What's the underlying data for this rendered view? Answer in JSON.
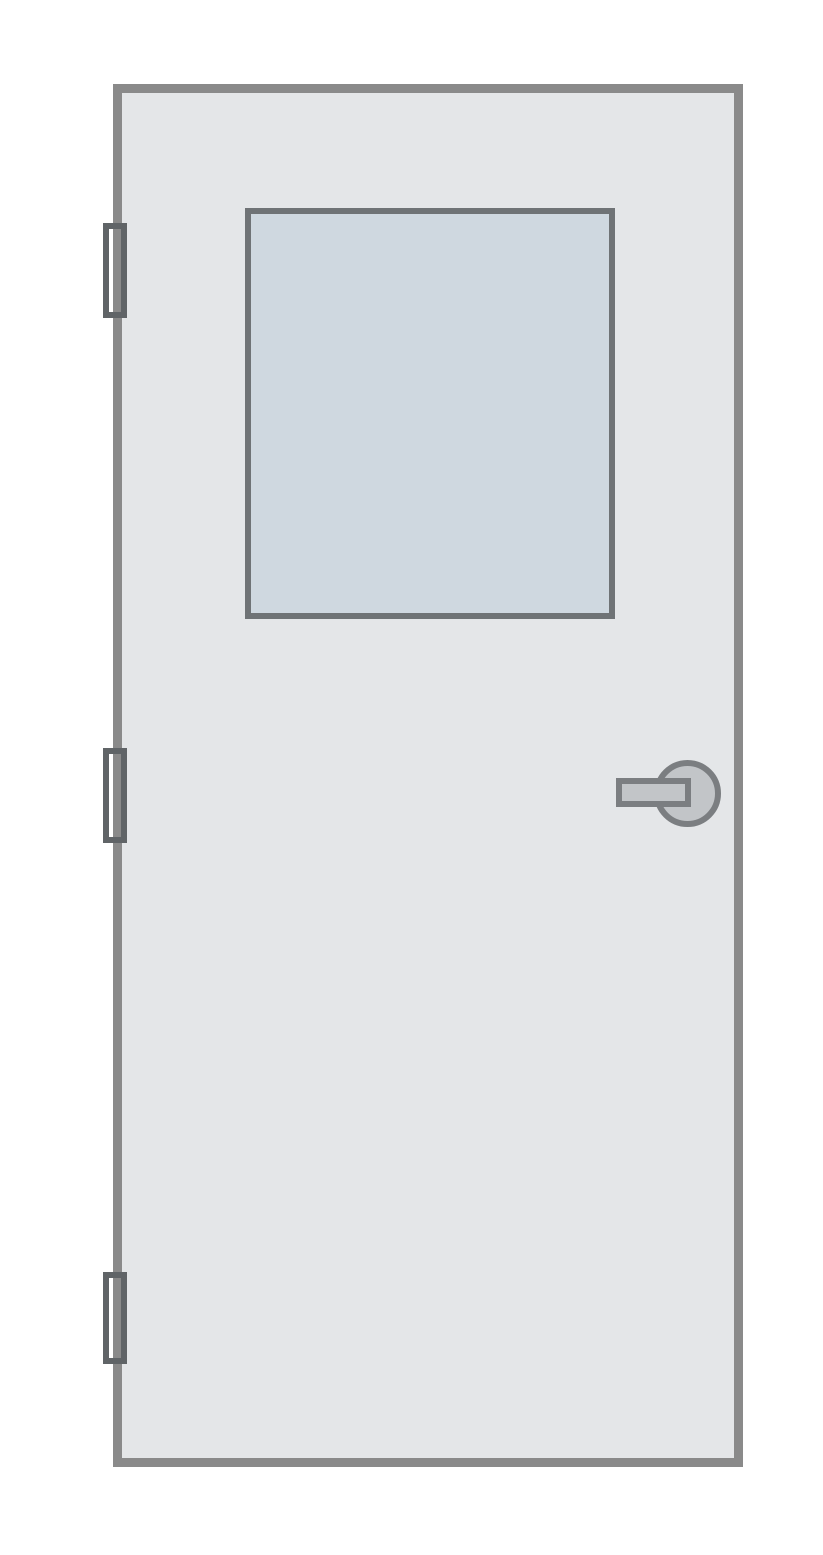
{
  "scene": {
    "description": "Flat illustration of a closed door: light gray panel, square glass window in the upper half, three hinges on the left edge, lever handle on the right side",
    "door": {
      "fill": "#e4e6e8",
      "border_color": "#8a8a8a"
    },
    "window": {
      "glass_fill": "#cfd8e0",
      "frame_color": "#6f7376"
    },
    "hinges": {
      "count": 3,
      "positions": [
        "top",
        "middle",
        "bottom"
      ],
      "outline_color": "#606467"
    },
    "handle": {
      "type": "lever",
      "side": "right",
      "fill": "#c2c5c8",
      "outline_color": "#7b7e81"
    }
  },
  "colors": {
    "canvas_bg": "#ffffff",
    "door_fill": "#e4e6e8",
    "door_border": "#8a8a8a",
    "glass_fill": "#cfd8e0",
    "glass_frame": "#6f7376",
    "hinge_outline": "#606467",
    "handle_fill": "#c2c5c8",
    "handle_outline": "#7b7e81"
  }
}
